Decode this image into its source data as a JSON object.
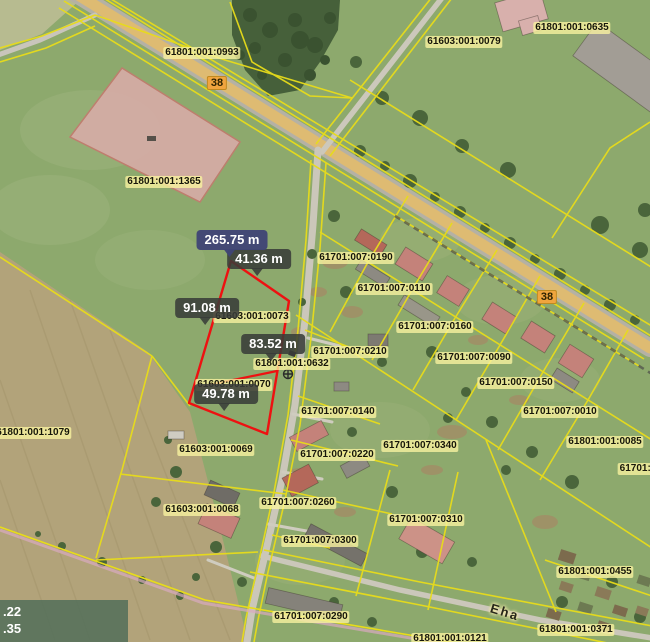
{
  "map": {
    "parcel_labels": [
      {
        "id": "61801:001:0993",
        "x": 202,
        "y": 53
      },
      {
        "id": "61603:001:0079",
        "x": 464,
        "y": 42
      },
      {
        "id": "61801:001:0635",
        "x": 572,
        "y": 28
      },
      {
        "id": "61801:001:1365",
        "x": 164,
        "y": 182
      },
      {
        "id": "61701:007:0190",
        "x": 356,
        "y": 258
      },
      {
        "id": "61701:007:0110",
        "x": 394,
        "y": 289
      },
      {
        "id": "61603:001:0073",
        "x": 252,
        "y": 317
      },
      {
        "id": "61701:007:0160",
        "x": 435,
        "y": 327
      },
      {
        "id": "61701:007:0210",
        "x": 350,
        "y": 352
      },
      {
        "id": "61701:007:0090",
        "x": 474,
        "y": 358
      },
      {
        "id": "61801:001:0632",
        "x": 292,
        "y": 364
      },
      {
        "id": "61701:007:0150",
        "x": 516,
        "y": 383
      },
      {
        "id": "61603:001:0070",
        "x": 234,
        "y": 385
      },
      {
        "id": "61701:007:0140",
        "x": 338,
        "y": 412
      },
      {
        "id": "61701:007:0010",
        "x": 560,
        "y": 412
      },
      {
        "id": "61801:001:1079",
        "x": 33,
        "y": 433
      },
      {
        "id": "61801:001:0085",
        "x": 605,
        "y": 442
      },
      {
        "id": "61701:007:0340",
        "x": 420,
        "y": 446
      },
      {
        "id": "61603:001:0069",
        "x": 216,
        "y": 450
      },
      {
        "id": "61701:007:0220",
        "x": 337,
        "y": 455
      },
      {
        "id": "61701:0",
        "x": 638,
        "y": 469
      },
      {
        "id": "61701:007:0260",
        "x": 298,
        "y": 503
      },
      {
        "id": "61603:001:0068",
        "x": 202,
        "y": 510
      },
      {
        "id": "61701:007:0310",
        "x": 426,
        "y": 520
      },
      {
        "id": "61701:007:0300",
        "x": 320,
        "y": 541
      },
      {
        "id": "61801:001:0455",
        "x": 595,
        "y": 572
      },
      {
        "id": "61701:007:0290",
        "x": 311,
        "y": 617
      },
      {
        "id": "61801:001:0371",
        "x": 576,
        "y": 630
      },
      {
        "id": "61801:001:0121",
        "x": 450,
        "y": 639
      }
    ],
    "road_shields": [
      {
        "text": "38",
        "x": 217,
        "y": 83
      },
      {
        "text": "38",
        "x": 547,
        "y": 297
      }
    ],
    "street_name": {
      "text": "Eha",
      "x": 505,
      "y": 612,
      "rotation_deg": 17
    },
    "measurement": {
      "total": {
        "text": "265.75 m",
        "x": 232,
        "y": 240
      },
      "segments": [
        {
          "text": "41.36 m",
          "x": 259,
          "y": 259
        },
        {
          "text": "91.08 m",
          "x": 207,
          "y": 308
        },
        {
          "text": "83.52 m",
          "x": 273,
          "y": 344
        },
        {
          "text": "49.78 m",
          "x": 226,
          "y": 394
        }
      ]
    },
    "coordinate_readout": {
      "line1": ".22",
      "line2": ".35"
    },
    "colors": {
      "parcel_line": "#e8dc1a",
      "selection_outline": "#ee1111",
      "label_bg": "#faf3a0",
      "total_tooltip_bg": "#3f4576",
      "segment_tooltip_bg": "#383c38",
      "road_fill": "#debb72"
    }
  }
}
